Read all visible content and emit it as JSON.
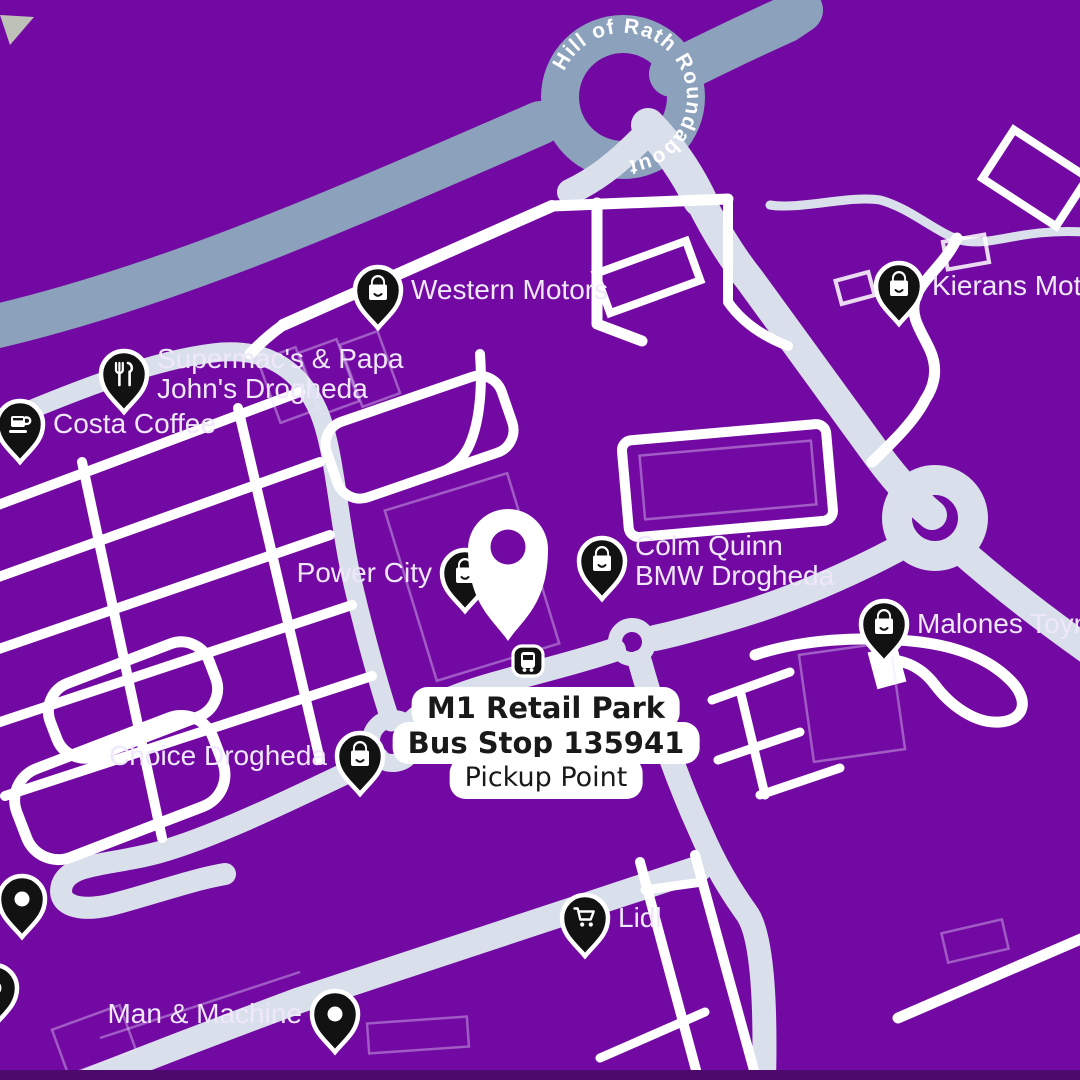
{
  "theme": {
    "bg": "#7309A3",
    "road-dark": "#8CA1BB",
    "road-light": "#D9E0EB",
    "label": "#EFE7FA",
    "strip": "#4C0A6B",
    "pin-black": "#121212",
    "pin-white": "#FFFFFF"
  },
  "roundabout_label": "Hill of Rath Roundabout",
  "pickup": {
    "line1": "M1 Retail Park",
    "line2": "Bus Stop 135941",
    "line3": "Pickup Point"
  },
  "pois": [
    {
      "id": "western-motors",
      "label": [
        "Western Motors"
      ],
      "icon": "shopping-bag",
      "x": 378,
      "y": 290,
      "side": "right"
    },
    {
      "id": "supermacs-papa-johns",
      "label": [
        "Supermac's & Papa",
        "John's Drogheda"
      ],
      "icon": "restaurant",
      "x": 124,
      "y": 374,
      "side": "right"
    },
    {
      "id": "costa-coffee",
      "label": [
        "Costa Coffee"
      ],
      "icon": "coffee",
      "x": 20,
      "y": 424,
      "side": "right"
    },
    {
      "id": "power-city",
      "label": [
        "Power City"
      ],
      "icon": "shopping-bag",
      "x": 465,
      "y": 573,
      "side": "left"
    },
    {
      "id": "colm-quinn-bmw",
      "label": [
        "Colm Quinn",
        "BMW Drogheda"
      ],
      "icon": "shopping-bag",
      "x": 602,
      "y": 561,
      "side": "right"
    },
    {
      "id": "kierans-motors",
      "label": [
        "Kierans Motors"
      ],
      "icon": "shopping-bag",
      "x": 899,
      "y": 286,
      "side": "right"
    },
    {
      "id": "malones-toymaster",
      "label": [
        "Malones Toymaster"
      ],
      "icon": "shopping-bag",
      "x": 884,
      "y": 624,
      "side": "right"
    },
    {
      "id": "choice-drogheda",
      "label": [
        "Choice Drogheda"
      ],
      "icon": "shopping-bag",
      "x": 360,
      "y": 756,
      "side": "left"
    },
    {
      "id": "lidl",
      "label": [
        "Lidl"
      ],
      "icon": "cart",
      "x": 585,
      "y": 918,
      "side": "right"
    },
    {
      "id": "man-and-machine",
      "label": [
        "Man & Machine"
      ],
      "icon": "dot",
      "x": 335,
      "y": 1014,
      "side": "left"
    },
    {
      "id": "unlabeled-1",
      "label": [],
      "icon": "dot",
      "x": 22,
      "y": 899,
      "side": "right"
    },
    {
      "id": "unlabeled-2",
      "label": [],
      "icon": "dot",
      "x": -6,
      "y": 988,
      "side": "right"
    }
  ]
}
